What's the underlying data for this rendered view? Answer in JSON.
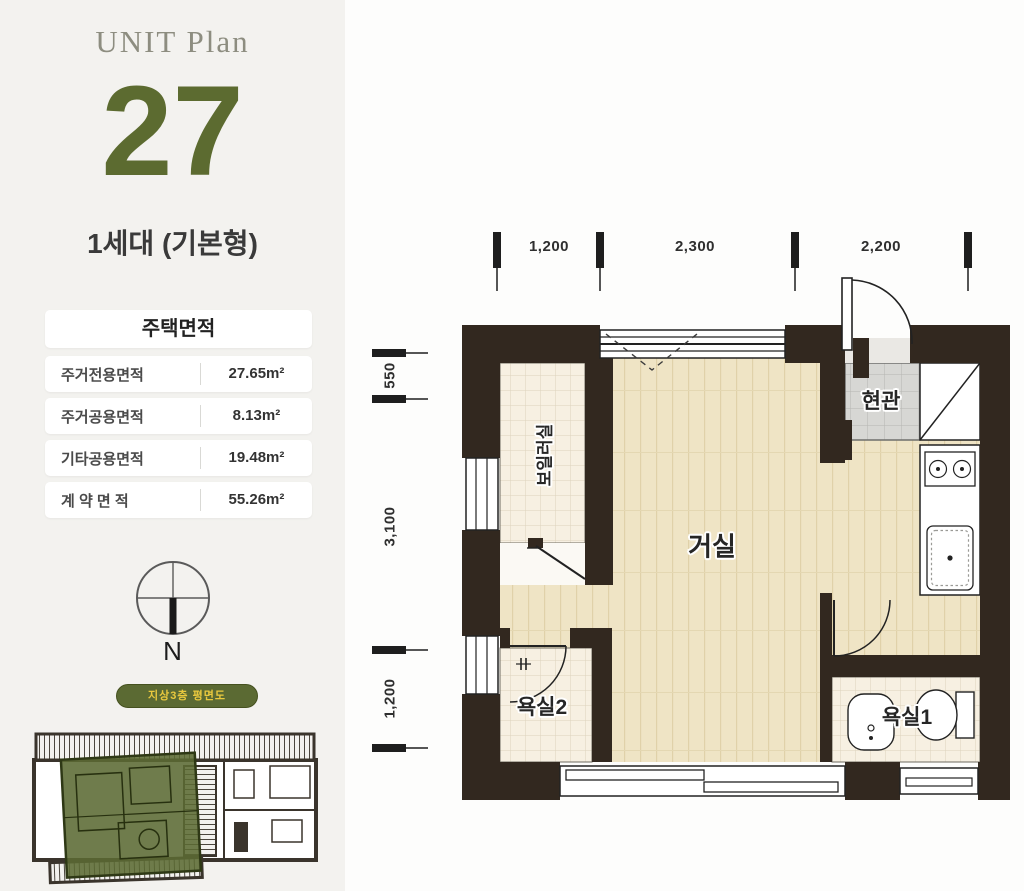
{
  "sidebar": {
    "plan_label": "UNIT Plan",
    "unit_number": "27",
    "unit_type": "1세대 (기본형)",
    "area_table": {
      "header": "주택면적",
      "rows": [
        {
          "label": "주거전용면적",
          "value": "27.65m²"
        },
        {
          "label": "주거공용면적",
          "value": "8.13m²"
        },
        {
          "label": "기타공용면적",
          "value": "19.48m²"
        },
        {
          "label": "계 약 면 적",
          "value": "55.26m²"
        }
      ]
    },
    "compass": {
      "north_label": "N"
    },
    "floor_badge": "지상3층 평면도"
  },
  "floor_plan": {
    "rooms": {
      "living": "거실",
      "boiler": "보일러실",
      "entrance": "현관",
      "bath1": "욕실1",
      "bath2": "욕실2"
    },
    "dimensions": {
      "top": [
        "1,200",
        "2,300",
        "2,200"
      ],
      "left": [
        "550",
        "3,100",
        "1,200"
      ]
    }
  },
  "colors": {
    "accent_olive": "#5c6b30",
    "badge_text": "#eac93e",
    "wall": "#32281f",
    "wood_floor": "#efe4c5",
    "tile_cream": "#f7f0e2",
    "tile_gray": "#d7d7d4"
  }
}
